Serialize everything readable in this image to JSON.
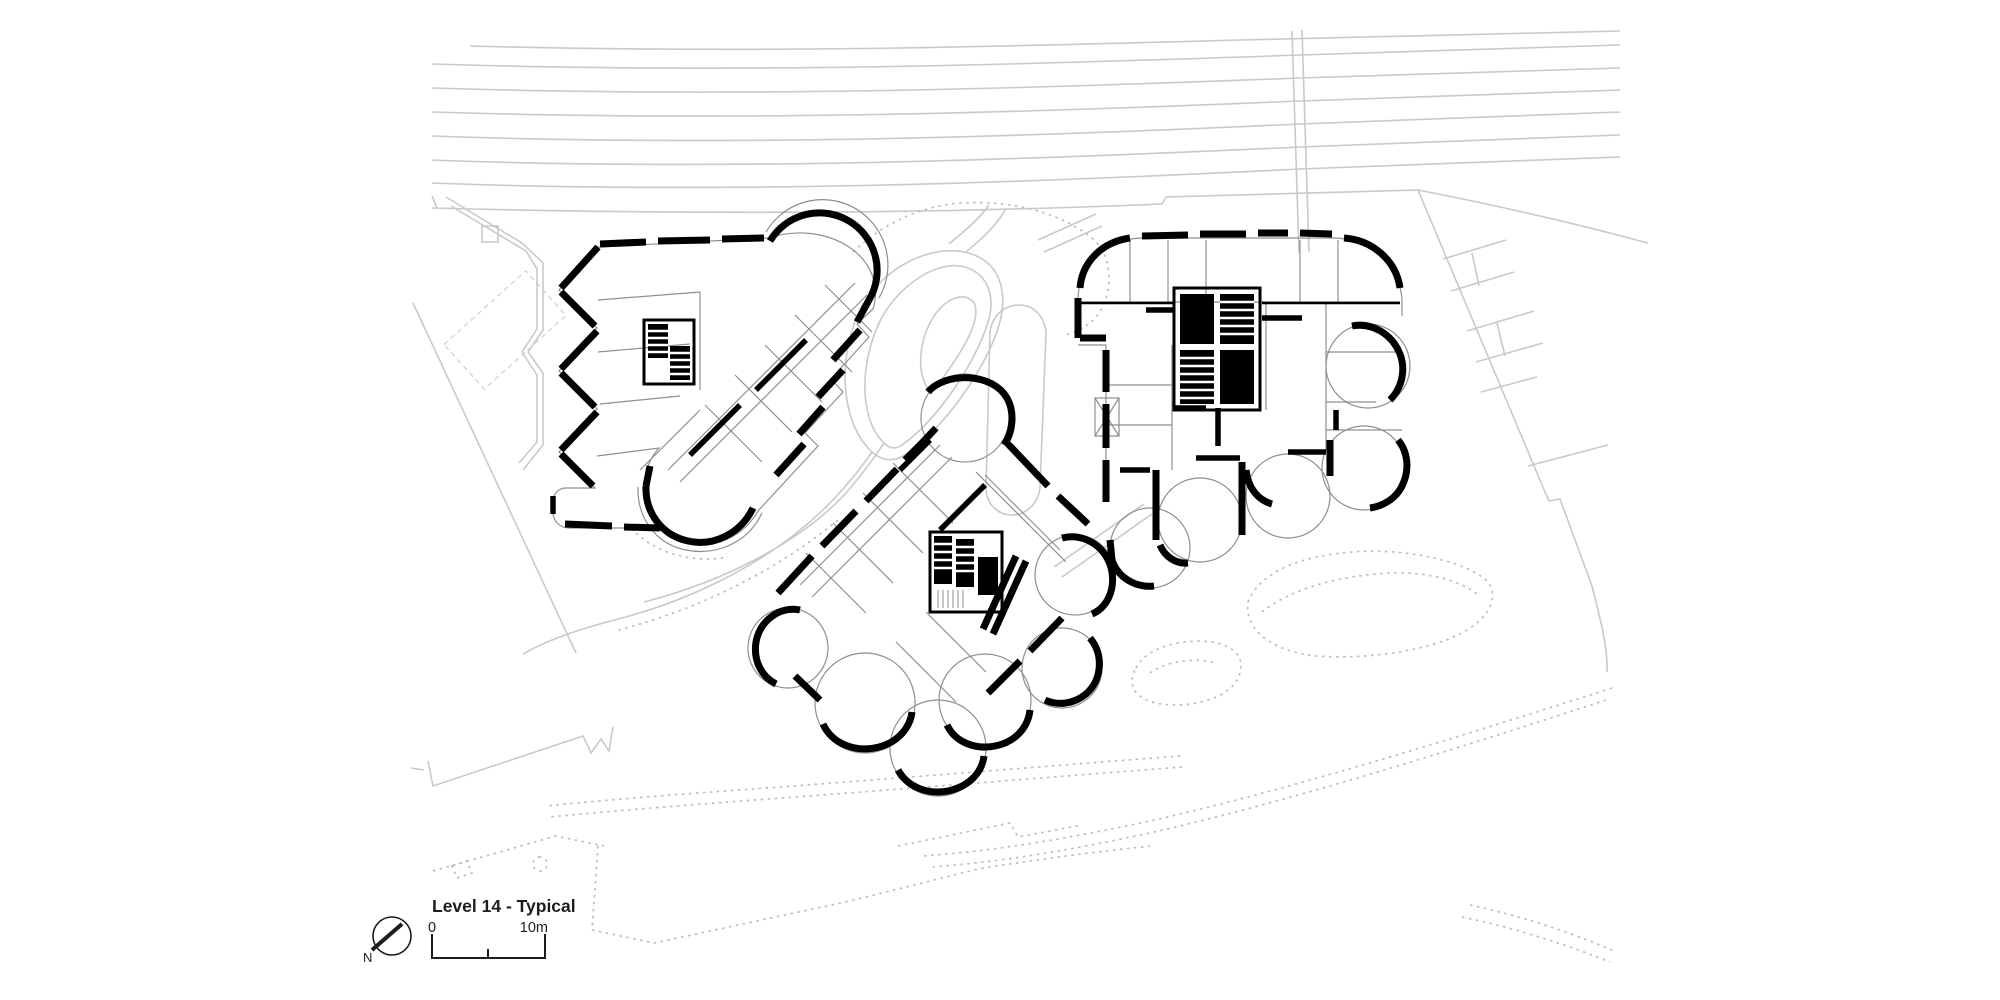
{
  "drawing": {
    "title": "Level 14 - Typical",
    "north_label": "N",
    "scale_bar": {
      "start": "0",
      "end": "10m"
    }
  },
  "colors": {
    "walls": "#000000",
    "site_lines": "#c9c9c9",
    "partitions": "#8f8f8f",
    "dotted_landscape": "#bdbdbd",
    "paper": "#ffffff",
    "text": "#1d1d1b"
  },
  "icons": {
    "north_arrow": "compass-circle-with-pointer"
  }
}
